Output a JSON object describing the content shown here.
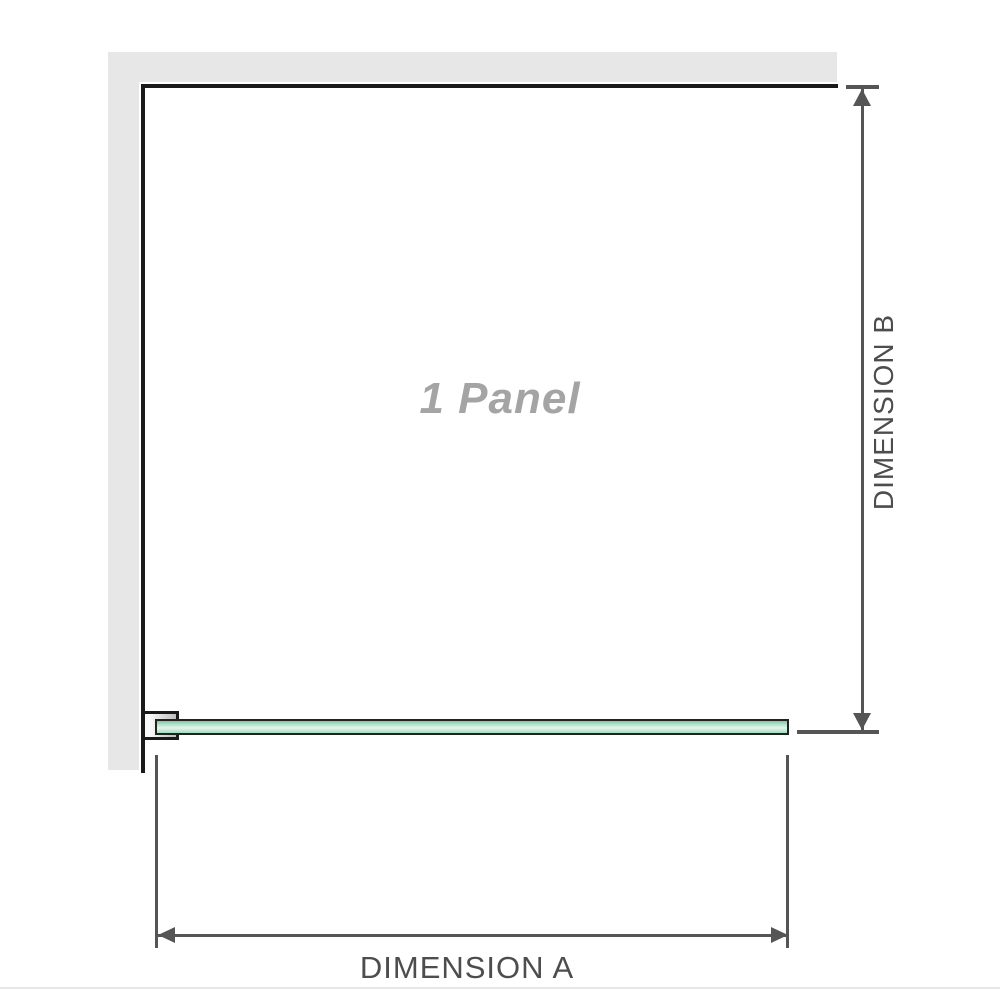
{
  "diagram": {
    "watermark": "1 Panel",
    "dimension_a": {
      "label": "DIMENSION A"
    },
    "dimension_b": {
      "label": "DIMENSION B"
    }
  },
  "colors": {
    "wall": "#e7e7e7",
    "frame": "#1a1a1a",
    "dim": "#555555",
    "dim_text": "#4d4d4d",
    "watermark_text": "#a4a4a4",
    "glass_border": "#20241f",
    "glass_top": "#82c4a2",
    "glass_mid": "#e2f5ec",
    "glass_bottom": "#a6dbc0",
    "bracket_fill_start": "#fafafa",
    "bracket_fill_end": "#bdbdbd",
    "divider": "#e9e5e2"
  }
}
